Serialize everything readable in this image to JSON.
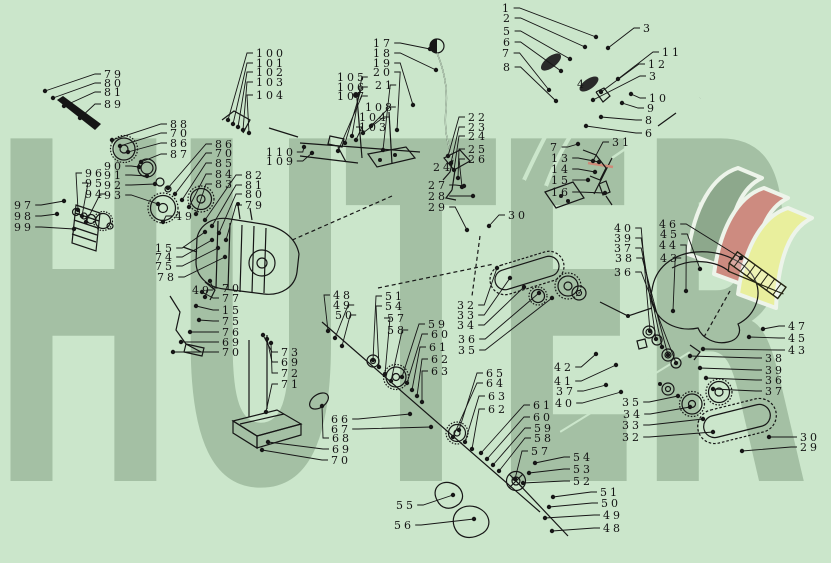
{
  "page": {
    "background_color": "#cbe6cb",
    "line_color": "#161616"
  },
  "watermark": {
    "text": "HUTER",
    "color": "#a4c0a4"
  },
  "logo": {
    "flag_colors": {
      "back": "#8da88c",
      "middle": "#cd8b80",
      "front": "#e9ef9d",
      "outline": "#edf4ea"
    },
    "highlight_part_color": "#cf8a78"
  },
  "diagram": {
    "description": "Exploded parts diagram with numbered callouts and leader lines",
    "labels": [
      [
        "79",
        104,
        74,
        45,
        91
      ],
      [
        "80",
        104,
        83,
        53,
        98
      ],
      [
        "81",
        104,
        92,
        64,
        106
      ],
      [
        "89",
        104,
        104,
        80,
        118
      ],
      [
        "88",
        170,
        124,
        112,
        140
      ],
      [
        "70",
        170,
        133,
        120,
        146
      ],
      [
        "86",
        170,
        143,
        128,
        152
      ],
      [
        "87",
        170,
        154,
        141,
        162
      ],
      [
        "86",
        215,
        144,
        168,
        188
      ],
      [
        "70",
        215,
        153,
        175,
        194
      ],
      [
        "85",
        215,
        163,
        182,
        200
      ],
      [
        "84",
        215,
        174,
        189,
        207
      ],
      [
        "83",
        215,
        184,
        196,
        214
      ],
      [
        "82",
        245,
        175,
        205,
        220
      ],
      [
        "81",
        245,
        185,
        212,
        226
      ],
      [
        "80",
        245,
        194,
        219,
        233
      ],
      [
        "79",
        245,
        205,
        226,
        240
      ],
      [
        "100",
        256,
        53,
        228,
        120
      ],
      [
        "101",
        256,
        63,
        233,
        124
      ],
      [
        "102",
        256,
        72,
        238,
        127
      ],
      [
        "103",
        256,
        82,
        243,
        130
      ],
      [
        "104",
        256,
        95,
        249,
        133
      ],
      [
        "110",
        266,
        152,
        304,
        147
      ],
      [
        "109",
        266,
        161,
        312,
        153
      ],
      [
        "105",
        337,
        77,
        352,
        136
      ],
      [
        "106",
        337,
        87,
        345,
        143
      ],
      [
        "107",
        337,
        96,
        338,
        151
      ],
      [
        "108",
        365,
        107,
        371,
        126
      ],
      [
        "104",
        359,
        117,
        363,
        133
      ],
      [
        "103",
        359,
        127,
        356,
        140
      ],
      [
        "97",
        14,
        205,
        64,
        201
      ],
      [
        "98",
        14,
        216,
        57,
        214
      ],
      [
        "99",
        14,
        227,
        74,
        229
      ],
      [
        "96",
        85,
        173,
        78,
        210
      ],
      [
        "95",
        85,
        183,
        82,
        216
      ],
      [
        "94",
        85,
        194,
        86,
        222
      ],
      [
        "90",
        104,
        166,
        139,
        167
      ],
      [
        "91",
        104,
        175,
        147,
        176
      ],
      [
        "92",
        104,
        185,
        155,
        184
      ],
      [
        "93",
        104,
        195,
        158,
        204
      ],
      [
        "49",
        175,
        216,
        163,
        222
      ],
      [
        "15",
        155,
        248,
        205,
        232
      ],
      [
        "74",
        155,
        257,
        212,
        240
      ],
      [
        "75",
        155,
        266,
        218,
        248
      ],
      [
        "78",
        157,
        277,
        225,
        257
      ],
      [
        "49",
        192,
        290,
        205,
        297
      ],
      [
        "70",
        222,
        288,
        210,
        281
      ],
      [
        "77",
        222,
        298,
        202,
        292
      ],
      [
        "15",
        222,
        310,
        196,
        306
      ],
      [
        "75",
        222,
        321,
        199,
        320
      ],
      [
        "76",
        222,
        332,
        190,
        332
      ],
      [
        "69",
        222,
        342,
        181,
        342
      ],
      [
        "70",
        222,
        352,
        173,
        352
      ],
      [
        "73",
        281,
        352,
        263,
        335
      ],
      [
        "69",
        281,
        362,
        267,
        339
      ],
      [
        "72",
        281,
        373,
        271,
        343
      ],
      [
        "71",
        281,
        384,
        266,
        412
      ],
      [
        "17",
        373,
        43,
        430,
        49
      ],
      [
        "18",
        373,
        53,
        436,
        70
      ],
      [
        "19",
        373,
        63,
        413,
        105
      ],
      [
        "20",
        373,
        72,
        397,
        130
      ],
      [
        "21",
        375,
        85,
        383,
        150
      ],
      [
        "22",
        468,
        117,
        448,
        156
      ],
      [
        "23",
        468,
        127,
        451,
        163
      ],
      [
        "24",
        468,
        136,
        454,
        170
      ],
      [
        "25",
        468,
        149,
        458,
        178
      ],
      [
        "26",
        468,
        159,
        462,
        187
      ],
      [
        "24",
        433,
        167,
        null,
        null
      ],
      [
        "27",
        428,
        185,
        464,
        186
      ],
      [
        "28",
        428,
        196,
        473,
        196
      ],
      [
        "29",
        428,
        207,
        467,
        230
      ],
      [
        "30",
        508,
        215,
        489,
        226
      ],
      [
        "1",
        502,
        8,
        596,
        37
      ],
      [
        "2",
        503,
        18,
        585,
        47
      ],
      [
        "5",
        503,
        31,
        570,
        59
      ],
      [
        "6",
        503,
        42,
        561,
        71
      ],
      [
        "7",
        502,
        53,
        549,
        90
      ],
      [
        "8",
        503,
        67,
        556,
        101
      ],
      [
        "3",
        643,
        28,
        608,
        48
      ],
      [
        "11",
        662,
        52,
        618,
        79
      ],
      [
        "12",
        648,
        64,
        601,
        92
      ],
      [
        "3",
        649,
        76,
        593,
        100
      ],
      [
        "10",
        649,
        98,
        631,
        94
      ],
      [
        "9",
        647,
        108,
        622,
        103
      ],
      [
        "8",
        645,
        120,
        601,
        117
      ],
      [
        "6",
        645,
        133,
        586,
        126
      ],
      [
        "4",
        577,
        84,
        null,
        null
      ],
      [
        "31",
        612,
        142,
        593,
        161
      ],
      [
        "7",
        550,
        147,
        578,
        144
      ],
      [
        "13",
        551,
        158,
        599,
        162
      ],
      [
        "14",
        551,
        169,
        595,
        172
      ],
      [
        "15",
        551,
        180,
        588,
        180
      ],
      [
        "16",
        551,
        192,
        605,
        193
      ],
      [
        "46",
        659,
        224,
        741,
        258
      ],
      [
        "45",
        660,
        234,
        700,
        269
      ],
      [
        "44",
        659,
        245,
        686,
        291
      ],
      [
        "43",
        660,
        258,
        673,
        311
      ],
      [
        "40",
        614,
        228,
        650,
        331
      ],
      [
        "39",
        614,
        238,
        656,
        339
      ],
      [
        "37",
        614,
        248,
        662,
        347
      ],
      [
        "38",
        615,
        258,
        668,
        355
      ],
      [
        "36",
        614,
        272,
        676,
        363
      ],
      [
        "47",
        788,
        326,
        763,
        329
      ],
      [
        "45",
        788,
        338,
        749,
        337
      ],
      [
        "43",
        788,
        350,
        703,
        349
      ],
      [
        "38",
        765,
        358,
        690,
        356
      ],
      [
        "39",
        765,
        370,
        700,
        368
      ],
      [
        "36",
        765,
        380,
        706,
        378
      ],
      [
        "37",
        765,
        391,
        713,
        389
      ],
      [
        "30",
        800,
        437,
        769,
        437
      ],
      [
        "29",
        800,
        447,
        742,
        451
      ],
      [
        "48",
        333,
        295,
        328,
        331
      ],
      [
        "49",
        333,
        305,
        335,
        338
      ],
      [
        "50",
        335,
        315,
        342,
        346
      ],
      [
        "51",
        385,
        296,
        373,
        360
      ],
      [
        "54",
        385,
        306,
        379,
        367
      ],
      [
        "57",
        387,
        318,
        385,
        374
      ],
      [
        "58",
        387,
        330,
        391,
        381
      ],
      [
        "59",
        428,
        324,
        402,
        377
      ],
      [
        "60",
        431,
        334,
        407,
        383
      ],
      [
        "61",
        429,
        347,
        412,
        390
      ],
      [
        "62",
        431,
        359,
        417,
        396
      ],
      [
        "63",
        431,
        371,
        422,
        402
      ],
      [
        "32",
        457,
        305,
        497,
        268
      ],
      [
        "33",
        457,
        315,
        510,
        278
      ],
      [
        "34",
        457,
        325,
        524,
        287
      ],
      [
        "36",
        458,
        339,
        539,
        293
      ],
      [
        "35",
        458,
        350,
        552,
        298
      ],
      [
        "65",
        486,
        373,
        459,
        430
      ],
      [
        "64",
        486,
        383,
        453,
        437
      ],
      [
        "63",
        488,
        396,
        465,
        442
      ],
      [
        "62",
        488,
        409,
        472,
        449
      ],
      [
        "61",
        533,
        405,
        481,
        453
      ],
      [
        "60",
        533,
        417,
        487,
        459
      ],
      [
        "59",
        534,
        428,
        493,
        465
      ],
      [
        "58",
        534,
        438,
        499,
        471
      ],
      [
        "57",
        531,
        451,
        515,
        479
      ],
      [
        "42",
        554,
        367,
        596,
        354
      ],
      [
        "41",
        554,
        381,
        616,
        365
      ],
      [
        "37",
        556,
        391,
        606,
        385
      ],
      [
        "40",
        555,
        403,
        621,
        392
      ],
      [
        "35",
        622,
        402,
        678,
        396
      ],
      [
        "34",
        623,
        414,
        690,
        407
      ],
      [
        "33",
        622,
        425,
        703,
        419
      ],
      [
        "32",
        622,
        437,
        713,
        432
      ],
      [
        "66",
        331,
        419,
        410,
        414
      ],
      [
        "67",
        331,
        429,
        431,
        427
      ],
      [
        "68",
        332,
        438,
        322,
        406
      ],
      [
        "69",
        332,
        449,
        268,
        442
      ],
      [
        "70",
        331,
        460,
        262,
        450
      ],
      [
        "55",
        396,
        505,
        453,
        495
      ],
      [
        "56",
        394,
        525,
        474,
        519
      ],
      [
        "54",
        573,
        457,
        535,
        463
      ],
      [
        "53",
        573,
        469,
        529,
        473
      ],
      [
        "52",
        573,
        481,
        523,
        483
      ],
      [
        "51",
        600,
        492,
        553,
        497
      ],
      [
        "50",
        601,
        503,
        549,
        507
      ],
      [
        "49",
        603,
        515,
        545,
        518
      ],
      [
        "48",
        603,
        528,
        552,
        531
      ]
    ]
  }
}
